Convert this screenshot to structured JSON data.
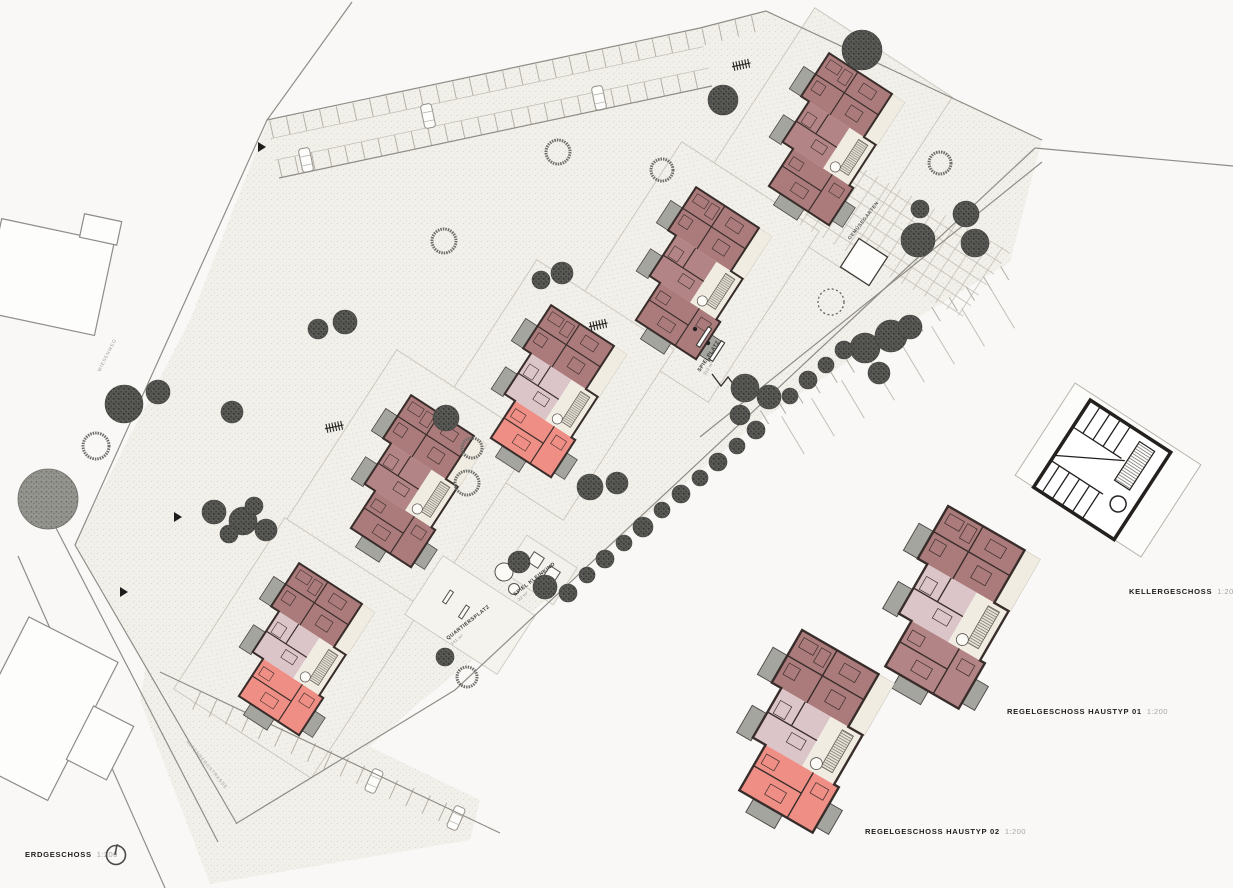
{
  "captions": {
    "erdgeschoss": {
      "label": "ERDGESCHOSS",
      "scale": "1:200"
    },
    "kellergeschoss": {
      "label": "KELLERGESCHOSS",
      "scale": "1:200"
    },
    "haustyp01": {
      "label": "REGELGESCHOSS HAUSTYP 01",
      "scale": "1:200"
    },
    "haustyp02": {
      "label": "REGELGESCHOSS HAUSTYP 02",
      "scale": "1:200"
    }
  },
  "site_labels": {
    "spielplatz": "SPIELPLATZ",
    "spielplatz_area": "313 m²",
    "quartiersplatz": "QUARTIERSPLATZ",
    "quartiersplatz_area": "141 m²",
    "spiel_kleinkind": "SPIEL KLEINKIND",
    "spiel_kleinkind_area": "32 m²",
    "gemuesegarten": "GEMÜSEGARTEN",
    "street_1": "WIESENWEG",
    "street_2": "ALTENBERGSTRASSE"
  },
  "colors": {
    "unit_rose": "#ab7b7c",
    "unit_rose2": "#b38485",
    "unit_pink": "#dcc5c8",
    "unit_salmon": "#ee8e85",
    "core_cream": "#f0ece1",
    "balcony_gray": "#a5a5a0",
    "wall_dark": "#382d2a",
    "ground_bg": "#f2f0ea",
    "ground_dot": "#d7d3ca",
    "line_gray": "#908d87"
  }
}
